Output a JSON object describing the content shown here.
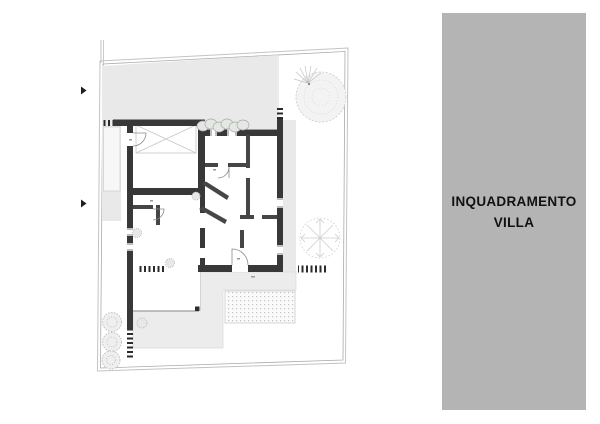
{
  "panel": {
    "title_line1": "INQUADRAMENTO",
    "title_line2": "VILLA",
    "bg_color": "#b4b4b4",
    "text_color": "#111111"
  },
  "plan": {
    "type": "architectural-site-plan",
    "colors": {
      "walls": "#383838",
      "driveway_area": "#e9e9e9",
      "terrace_area": "#ececec",
      "boundary_line": "#b0b0b0",
      "paper": "#ffffff"
    },
    "features": [
      "plot-boundary",
      "driveway-area",
      "entrance-walkway",
      "villa-floor-plan",
      "carport-x-canopy",
      "hedge",
      "window-hatches",
      "door-arcs",
      "pool-patio",
      "terrace",
      "garden-trees",
      "access-arrows"
    ]
  }
}
